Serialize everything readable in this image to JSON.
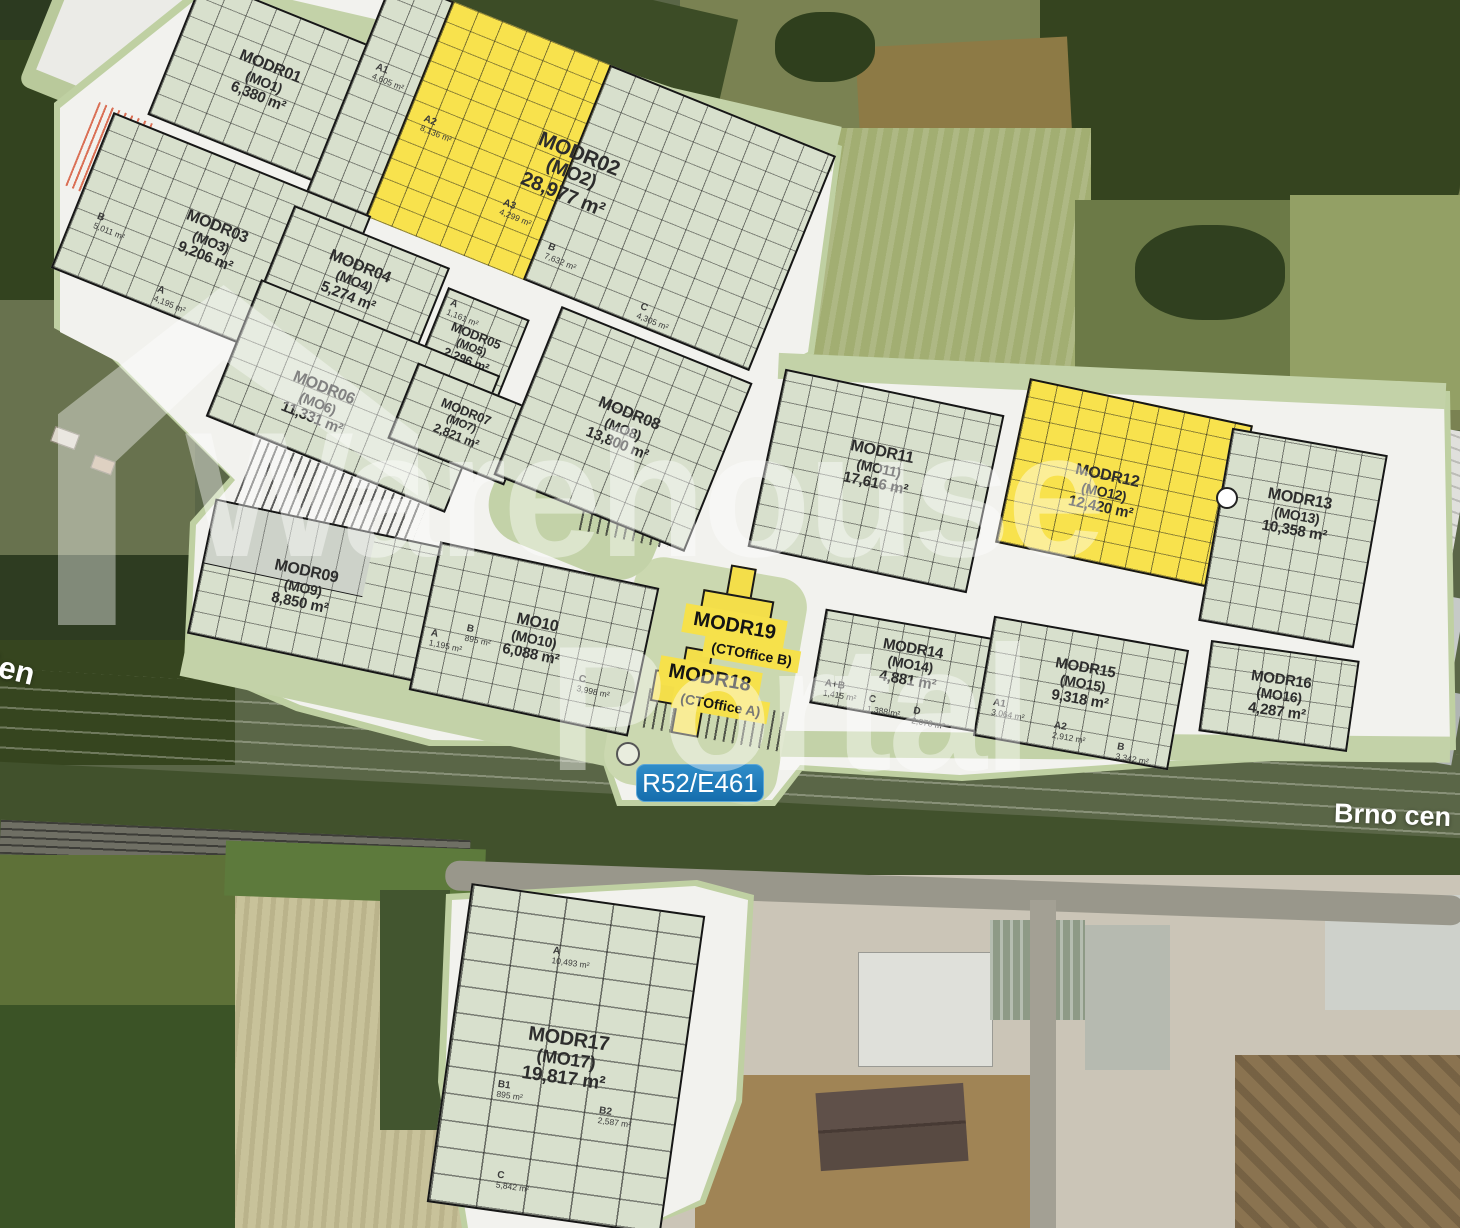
{
  "watermark": {
    "line1": "Warehouse",
    "line2": "Portal"
  },
  "road": {
    "badge": "R52/E461",
    "left_label": "ien",
    "right_label": "Brno cen"
  },
  "colors": {
    "highlight_yellow": "#f8e24d",
    "plan_green": "#c3d2a8",
    "badge_blue": "#1e7cc0",
    "building_fill": "#d8e0cd"
  },
  "offices": [
    {
      "name": "MODR19",
      "code": "(CTOffice B)"
    },
    {
      "name": "MODR18",
      "code": "(CTOffice A)"
    }
  ],
  "buildings": [
    {
      "name": "MODR01",
      "code": "(MO1)",
      "area": "6,380 m²"
    },
    {
      "name": "MODR02",
      "code": "(MO2)",
      "area": "28,977 m²",
      "units": [
        {
          "label": "A1",
          "area": "4,605 m²"
        },
        {
          "label": "A2",
          "area": "8,136 m²"
        },
        {
          "label": "A3",
          "area": "4,299 m²"
        },
        {
          "label": "B",
          "area": "7,632 m²"
        },
        {
          "label": "C",
          "area": "4,305 m²"
        }
      ]
    },
    {
      "name": "MODR03",
      "code": "(MO3)",
      "area": "9,206 m²",
      "units": [
        {
          "label": "B",
          "area": "5,011 m²"
        },
        {
          "label": "A",
          "area": "4,195 m²"
        }
      ]
    },
    {
      "name": "MODR04",
      "code": "(MO4)",
      "area": "5,274 m²"
    },
    {
      "name": "MODR05",
      "code": "(MO5)",
      "area": "2,296 m²",
      "units": [
        {
          "label": "A",
          "area": "1,161 m²"
        },
        {
          "label": "B",
          "area": "1,135 m²"
        }
      ]
    },
    {
      "name": "MODR06",
      "code": "(MO6)",
      "area": "11,331 m²"
    },
    {
      "name": "MODR07",
      "code": "(MO7)",
      "area": "2,821 m²"
    },
    {
      "name": "MODR08",
      "code": "(MO8)",
      "area": "13,800 m²"
    },
    {
      "name": "MODR09",
      "code": "(MO9)",
      "area": "8,850 m²"
    },
    {
      "name": "MO10",
      "code": "(MO10)",
      "area": "6,088 m²",
      "units": [
        {
          "label": "A",
          "area": "1,195 m²"
        },
        {
          "label": "B",
          "area": "895 m²"
        },
        {
          "label": "C",
          "area": "3,998 m²"
        }
      ]
    },
    {
      "name": "MODR11",
      "code": "(MO11)",
      "area": "17,616 m²"
    },
    {
      "name": "MODR12",
      "code": "(MO12)",
      "area": "12,420 m²"
    },
    {
      "name": "MODR13",
      "code": "(MO13)",
      "area": "10,358 m²"
    },
    {
      "name": "MODR14",
      "code": "(MO14)",
      "area": "4,881 m²",
      "units": [
        {
          "label": "A+B",
          "area": "1,415 m²"
        },
        {
          "label": "C",
          "area": "1,388 m²"
        },
        {
          "label": "D",
          "area": "2,078 m²"
        }
      ]
    },
    {
      "name": "MODR15",
      "code": "(MO15)",
      "area": "9,318 m²",
      "units": [
        {
          "label": "A1",
          "area": "3,064 m²"
        },
        {
          "label": "A2",
          "area": "2,912 m²"
        },
        {
          "label": "B",
          "area": "3,342 m²"
        }
      ]
    },
    {
      "name": "MODR16",
      "code": "(MO16)",
      "area": "4,287 m²"
    },
    {
      "name": "MODR17",
      "code": "(MO17)",
      "area": "19,817 m²",
      "units": [
        {
          "label": "A",
          "area": "10,493 m²"
        },
        {
          "label": "B1",
          "area": "895 m²"
        },
        {
          "label": "B2",
          "area": "2,587 m²"
        },
        {
          "label": "C",
          "area": "5,842 m²"
        }
      ]
    }
  ]
}
